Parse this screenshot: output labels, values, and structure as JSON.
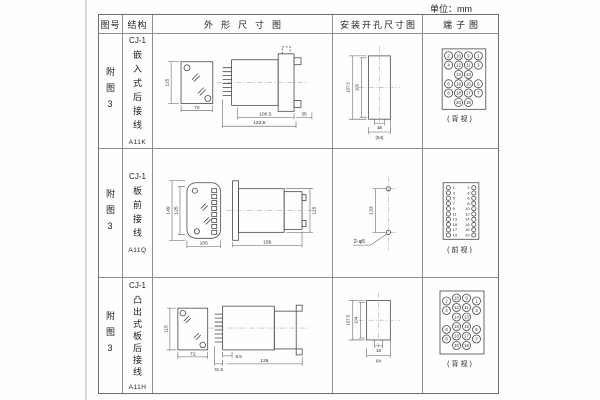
{
  "unit_label": "单位：mm",
  "headers": {
    "fig": "图号",
    "structure": "结构",
    "outline": "外形尺寸图",
    "install": "安装开孔尺寸图",
    "terminal": "端子图"
  },
  "rows": [
    {
      "fig_no": "附图3",
      "model": "CJ-1",
      "structure_desc": "嵌入式后接线",
      "code": "A11K",
      "outline": {
        "front_height": "115",
        "front_width": "72",
        "side_len1": "100.5",
        "side_len2": "122.5",
        "side_len3": "35"
      },
      "install": {
        "height_outer": "107.5",
        "height_inner": "105",
        "width_inner": "16",
        "width_outer": "(64)"
      },
      "terminal": {
        "view_label": "(背视)",
        "grid": [
          [
            2,
            10,
            9,
            1
          ],
          [
            4,
            12,
            11,
            3
          ],
          [
            null,
            14,
            13,
            null
          ],
          [
            6,
            16,
            15,
            5
          ],
          [
            8,
            18,
            17,
            7
          ],
          [
            null,
            20,
            19,
            null
          ]
        ]
      }
    },
    {
      "fig_no": "附图3",
      "model": "CJ-1",
      "structure_desc": "板前接线",
      "code": "A11Q",
      "outline": {
        "front_height_outer": "149",
        "front_height_inner": "125",
        "front_width": "105",
        "side_length": "156",
        "side_height": "115"
      },
      "install": {
        "hole_spacing": "133",
        "hole_label": "2-φ5"
      },
      "terminal": {
        "view_label": "(前视)",
        "left_column": [
          1,
          3,
          5,
          7,
          9,
          11,
          13,
          15,
          17,
          19
        ],
        "right_column": [
          2,
          4,
          6,
          8,
          10,
          12,
          14,
          16,
          18,
          20
        ]
      }
    },
    {
      "fig_no": "附图3",
      "model": "CJ-1",
      "structure_desc": "凸出式板后接线",
      "code": "A11H",
      "outline": {
        "front_height": "115",
        "front_width": "72",
        "side_len1": "31.5",
        "side_len2": "9.5",
        "side_len3": "126"
      },
      "install": {
        "height_outer": "107.5",
        "height_inner": "104",
        "width_inner": "16",
        "width_outer": "64"
      },
      "terminal": {
        "view_label": "(背视)",
        "grid": [
          [
            2,
            10,
            9,
            1
          ],
          [
            4,
            12,
            11,
            3
          ],
          [
            null,
            14,
            13,
            null
          ],
          [
            6,
            16,
            15,
            5
          ],
          [
            8,
            18,
            17,
            7
          ],
          [
            null,
            20,
            19,
            null
          ]
        ]
      }
    }
  ],
  "colors": {
    "line": "#474747",
    "table_border": "#8d8d8d",
    "text": "#222222",
    "background": "#fefefe"
  }
}
